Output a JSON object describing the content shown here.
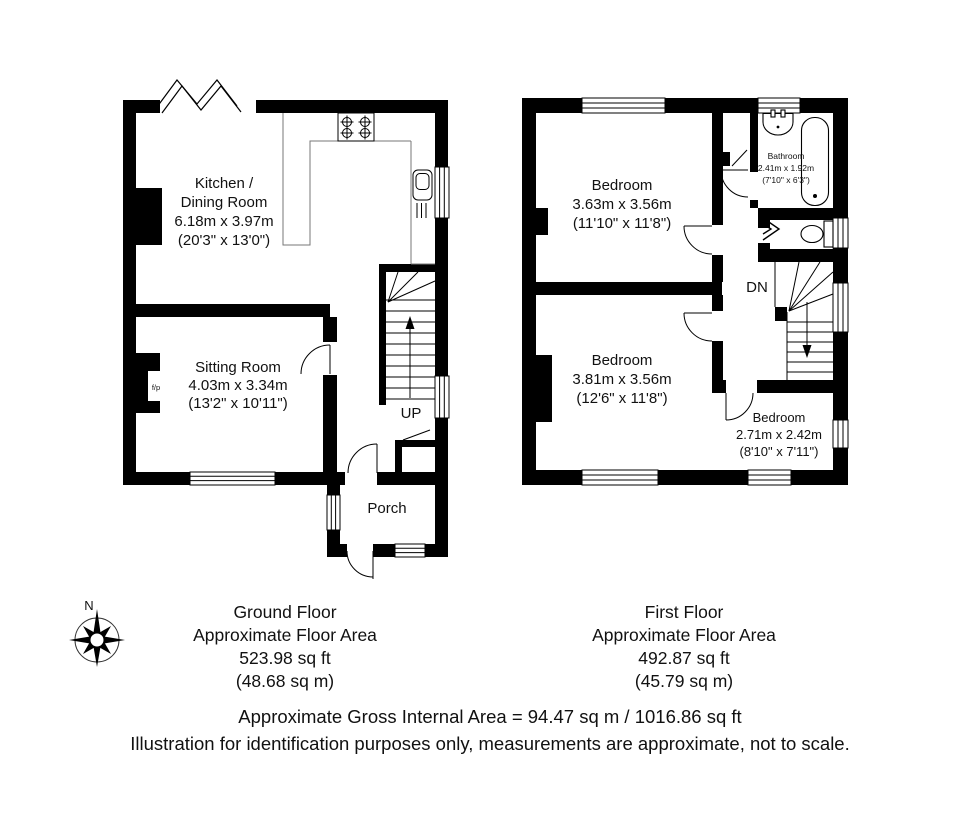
{
  "ground_floor": {
    "rooms": {
      "kitchen": {
        "name_line1": "Kitchen /",
        "name_line2": "Dining Room",
        "size_m": "6.18m x 3.97m",
        "size_ft": "(20'3\" x 13'0\")"
      },
      "sitting": {
        "name": "Sitting Room",
        "size_m": "4.03m x 3.34m",
        "size_ft": "(13'2\" x 10'11\")"
      },
      "porch": {
        "name": "Porch"
      }
    },
    "stairs_label": "UP",
    "fireplace_label": "f/p",
    "summary": {
      "title": "Ground Floor",
      "subtitle": "Approximate Floor Area",
      "area_ft": "523.98 sq ft",
      "area_m": "(48.68 sq m)"
    }
  },
  "first_floor": {
    "rooms": {
      "bedroom1": {
        "name": "Bedroom",
        "size_m": "3.63m x 3.56m",
        "size_ft": "(11'10\" x 11'8\")"
      },
      "bedroom2": {
        "name": "Bedroom",
        "size_m": "3.81m x 3.56m",
        "size_ft": "(12'6\" x 11'8\")"
      },
      "bedroom3": {
        "name": "Bedroom",
        "size_m": "2.71m x 2.42m",
        "size_ft": "(8'10\" x 7'11\")"
      },
      "bathroom": {
        "name": "Bathroom",
        "size_m": "2.41m x 1.92m",
        "size_ft": "(7'10\" x 6'3\")"
      }
    },
    "stairs_label": "DN",
    "summary": {
      "title": "First Floor",
      "subtitle": "Approximate Floor Area",
      "area_ft": "492.87 sq ft",
      "area_m": "(45.79 sq m)"
    }
  },
  "compass": {
    "north_label": "N"
  },
  "footer": {
    "gross_area": "Approximate Gross Internal Area = 94.47 sq m / 1016.86 sq ft",
    "disclaimer": "Illustration for identification purposes only, measurements are approximate, not to scale."
  },
  "colors": {
    "wall": "#000000",
    "line": "#000000",
    "background": "#ffffff"
  }
}
